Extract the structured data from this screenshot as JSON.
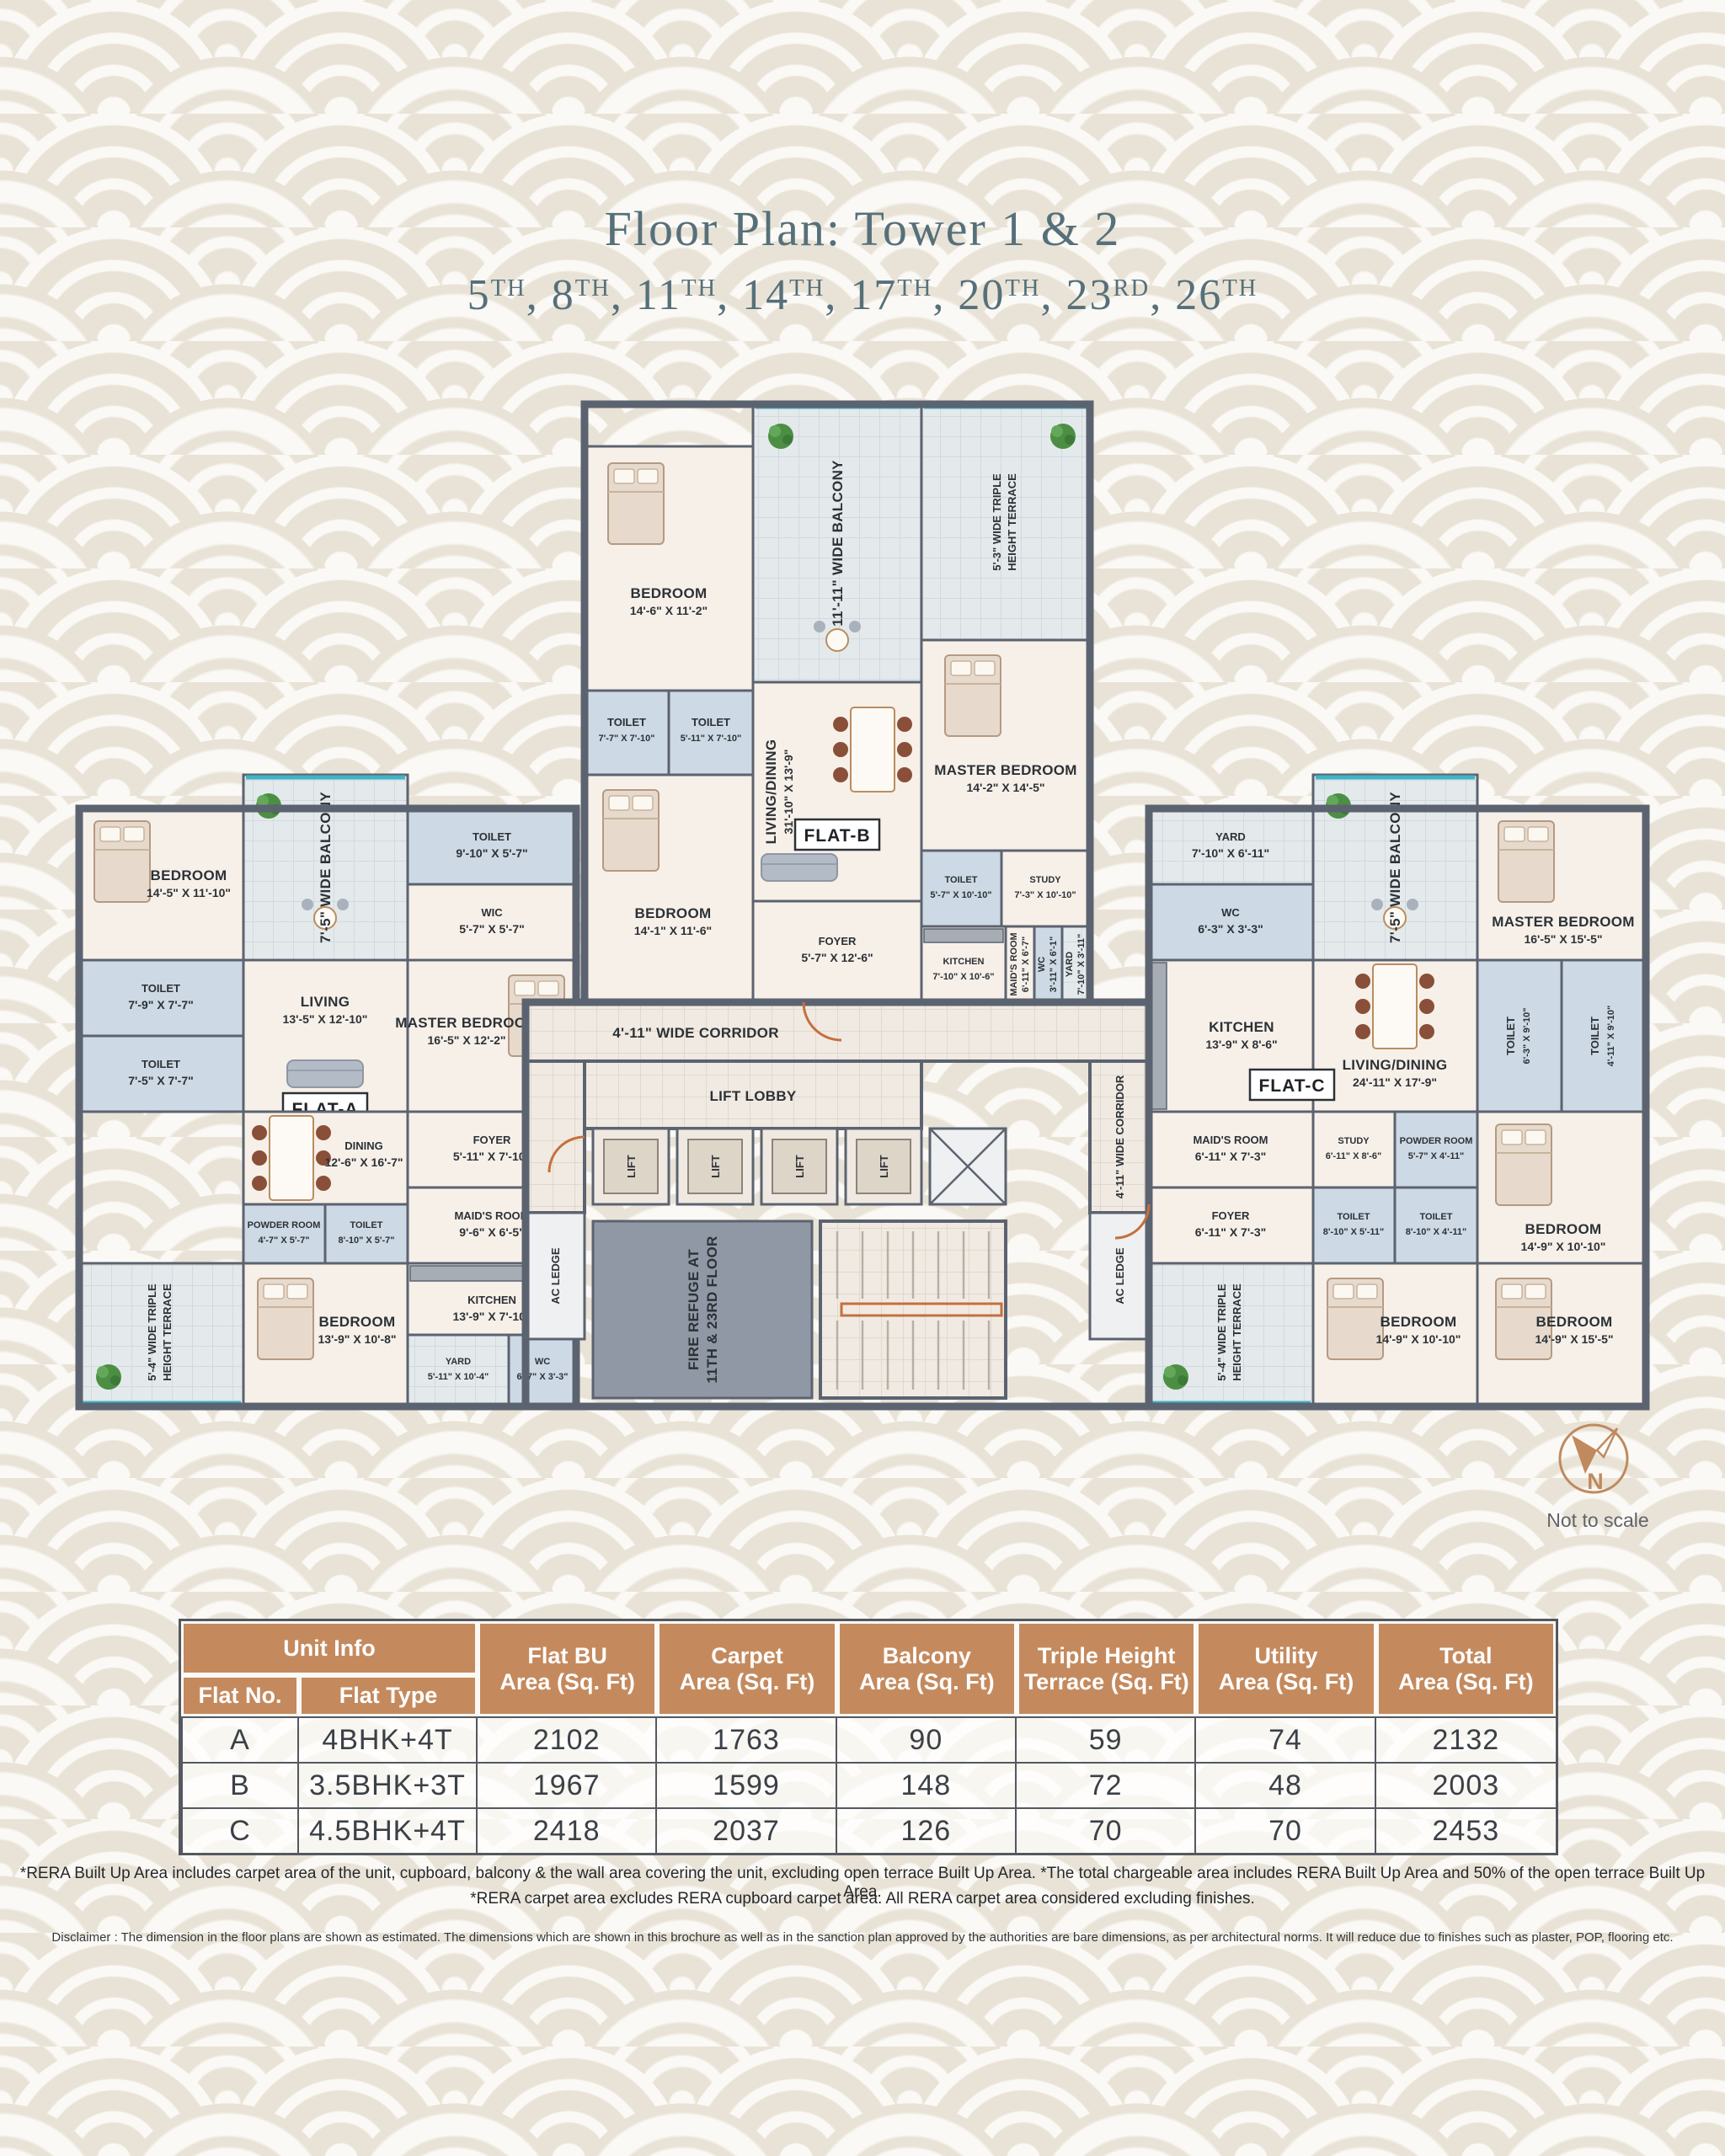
{
  "colors": {
    "accent_tan": "#c48a5e",
    "wall": "#5c6370",
    "title_slate": "#56707a",
    "teal_edge": "#3eb4c6"
  },
  "title_block": {
    "title": "Floor Plan: Tower 1 & 2",
    "comma": ", ",
    "floors": [
      {
        "n": "5",
        "s": "TH"
      },
      {
        "n": "8",
        "s": "TH"
      },
      {
        "n": "11",
        "s": "TH"
      },
      {
        "n": "14",
        "s": "TH"
      },
      {
        "n": "17",
        "s": "TH"
      },
      {
        "n": "20",
        "s": "TH"
      },
      {
        "n": "23",
        "s": "RD"
      },
      {
        "n": "26",
        "s": "TH"
      }
    ]
  },
  "plan": {
    "core": {
      "corridor": "4'-11\" WIDE CORRIDOR",
      "lift_lobby": "LIFT LOBBY",
      "lift": "LIFT",
      "ac_ledge": "AC LEDGE",
      "fire_refuge_l1": "FIRE REFUGE AT",
      "fire_refuge_l2": "11TH & 23RD FLOOR"
    },
    "flat_a": {
      "tag": "FLAT-A",
      "balcony": "7'-5\" WIDE BALCONY",
      "terrace": {
        "l1": "5'-4\" WIDE TRIPLE",
        "l2": "HEIGHT TERRACE"
      },
      "bed1": {
        "name": "BEDROOM",
        "dim": "14'-5\" X 11'-10\""
      },
      "toilet1": {
        "name": "TOILET",
        "dim": "9'-10\" X 5'-7\""
      },
      "wic": {
        "name": "WIC",
        "dim": "5'-7\" X 5'-7\""
      },
      "living": {
        "name": "LIVING",
        "dim": "13'-5\" X 12'-10\""
      },
      "master": {
        "name": "MASTER BEDROOM",
        "dim": "16'-5\" X 12'-2\""
      },
      "toilet2": {
        "name": "TOILET",
        "dim": "7'-9\" X 7'-7\""
      },
      "toilet3": {
        "name": "TOILET",
        "dim": "7'-5\" X 7'-7\""
      },
      "bed2": {
        "name": "BEDROOM",
        "dim": "12'-10\" X 11'-10\""
      },
      "dining": {
        "name": "DINING",
        "dim": "12'-6\" X 16'-7\""
      },
      "powder": {
        "name": "POWDER ROOM",
        "dim": "4'-7\" X 5'-7\""
      },
      "toilet4": {
        "name": "TOILET",
        "dim": "8'-10\" X 5'-7\""
      },
      "foyer": {
        "name": "FOYER",
        "dim": "5'-11\" X 7'-10\""
      },
      "maid": {
        "name": "MAID'S ROOM",
        "dim": "9'-6\" X 6'-5\""
      },
      "bed3": {
        "name": "BEDROOM",
        "dim": "13'-9\" X 10'-8\""
      },
      "kitchen": {
        "name": "KITCHEN",
        "dim": "13'-9\" X 7'-10\""
      },
      "yard": {
        "name": "YARD",
        "dim": "5'-11\" X 10'-4\""
      },
      "wc": {
        "name": "WC",
        "dim": "6'-7\" X 3'-3\""
      }
    },
    "flat_b": {
      "tag": "FLAT-B",
      "balcony": "11'-11\" WIDE BALCONY",
      "terrace": {
        "l1": "5'-3\" WIDE TRIPLE",
        "l2": "HEIGHT TERRACE"
      },
      "bed1": {
        "name": "BEDROOM",
        "dim": "14'-6\" X 11'-2\""
      },
      "master": {
        "name": "MASTER BEDROOM",
        "dim": "14'-2\" X 14'-5\""
      },
      "living": {
        "name": "LIVING/DINING",
        "dim": "31'-10\" X 13'-9\""
      },
      "toilet1": {
        "name": "TOILET",
        "dim": "7'-7\" X 7'-10\""
      },
      "toilet2": {
        "name": "TOILET",
        "dim": "5'-11\" X 7'-10\""
      },
      "bed2": {
        "name": "BEDROOM",
        "dim": "14'-1\" X 11'-6\""
      },
      "foyer": {
        "name": "FOYER",
        "dim": "5'-7\" X 12'-6\""
      },
      "toilet3": {
        "name": "TOILET",
        "dim": "5'-7\" X 10'-10\""
      },
      "study": {
        "name": "STUDY",
        "dim": "7'-3\" X 10'-10\""
      },
      "kitchen": {
        "name": "KITCHEN",
        "dim": "7'-10\" X 10'-6\""
      },
      "maid": {
        "name": "MAID'S ROOM",
        "dim": "6'-11\" X 6'-7\""
      },
      "wc": {
        "name": "WC",
        "dim": "3'-11\" X 6'-1\""
      },
      "yard": {
        "name": "YARD",
        "dim": "7'-10\" X 3'-11\""
      }
    },
    "flat_c": {
      "tag": "FLAT-C",
      "balcony": "7'-5\" WIDE BALCONY",
      "terrace": {
        "l1": "5'-4\" WIDE TRIPLE",
        "l2": "HEIGHT TERRACE"
      },
      "living": {
        "name": "LIVING/DINING",
        "dim": "24'-11\" X 17'-9\""
      },
      "kitchen": {
        "name": "KITCHEN",
        "dim": "13'-9\" X 8'-6\""
      },
      "wc": {
        "name": "WC",
        "dim": "6'-3\" X 3'-3\""
      },
      "yard": {
        "name": "YARD",
        "dim": "7'-10\" X 6'-11\""
      },
      "maid": {
        "name": "MAID'S ROOM",
        "dim": "6'-11\" X 7'-3\""
      },
      "foyer": {
        "name": "FOYER",
        "dim": "6'-11\" X 7'-3\""
      },
      "study": {
        "name": "STUDY",
        "dim": "6'-11\" X 8'-6\""
      },
      "powder": {
        "name": "POWDER ROOM",
        "dim": "5'-7\" X 4'-11\""
      },
      "master": {
        "name": "MASTER BEDROOM",
        "dim": "16'-5\" X 15'-5\""
      },
      "toilet1": {
        "name": "TOILET",
        "dim": "6'-3\" X 9'-10\""
      },
      "toilet2": {
        "name": "TOILET",
        "dim": "4'-11\" X 9'-10\""
      },
      "toilet3": {
        "name": "TOILET",
        "dim": "8'-10\" X 5'-11\""
      },
      "toilet4": {
        "name": "TOILET",
        "dim": "8'-10\" X 4'-11\""
      },
      "bed1": {
        "name": "BEDROOM",
        "dim": "14'-9\" X 10'-10\""
      },
      "bed2": {
        "name": "BEDROOM",
        "dim": "14'-9\" X 10'-10\""
      },
      "bed3": {
        "name": "BEDROOM",
        "dim": "14'-9\" X 15'-5\""
      }
    }
  },
  "compass": {
    "letter": "N",
    "note": "Not to scale"
  },
  "table": {
    "unit_info": "Unit Info",
    "flat_no": "Flat No.",
    "flat_type": "Flat Type",
    "cols": [
      {
        "l1": "Flat BU",
        "l2": "Area (Sq. Ft)"
      },
      {
        "l1": "Carpet",
        "l2": "Area (Sq. Ft)"
      },
      {
        "l1": "Balcony",
        "l2": "Area (Sq. Ft)"
      },
      {
        "l1": "Triple Height",
        "l2": "Terrace (Sq. Ft)"
      },
      {
        "l1": "Utility",
        "l2": "Area (Sq. Ft)"
      },
      {
        "l1": "Total",
        "l2": "Area (Sq. Ft)"
      }
    ],
    "rows": [
      {
        "flat": "A",
        "type": "4BHK+4T",
        "bu": "2102",
        "carpet": "1763",
        "balcony": "90",
        "terrace": "59",
        "utility": "74",
        "total": "2132"
      },
      {
        "flat": "B",
        "type": "3.5BHK+3T",
        "bu": "1967",
        "carpet": "1599",
        "balcony": "148",
        "terrace": "72",
        "utility": "48",
        "total": "2003"
      },
      {
        "flat": "C",
        "type": "4.5BHK+4T",
        "bu": "2418",
        "carpet": "2037",
        "balcony": "126",
        "terrace": "70",
        "utility": "70",
        "total": "2453"
      }
    ]
  },
  "footnotes": {
    "line1": "*RERA Built Up Area includes carpet area of the unit, cupboard, balcony & the wall area covering the unit, excluding open terrace Built Up Area. *The total chargeable area includes RERA Built Up Area and 50% of the open terrace Built Up Area.",
    "line2": "*RERA carpet area excludes RERA cupboard carpet area. All RERA carpet area considered excluding finishes.",
    "disclaimer": "Disclaimer : The dimension in the floor plans are shown as estimated. The dimensions which are shown in this brochure as well as in the sanction plan approved by the authorities are bare dimensions, as per architectural norms. It will reduce due to finishes such as plaster, POP, flooring etc."
  }
}
